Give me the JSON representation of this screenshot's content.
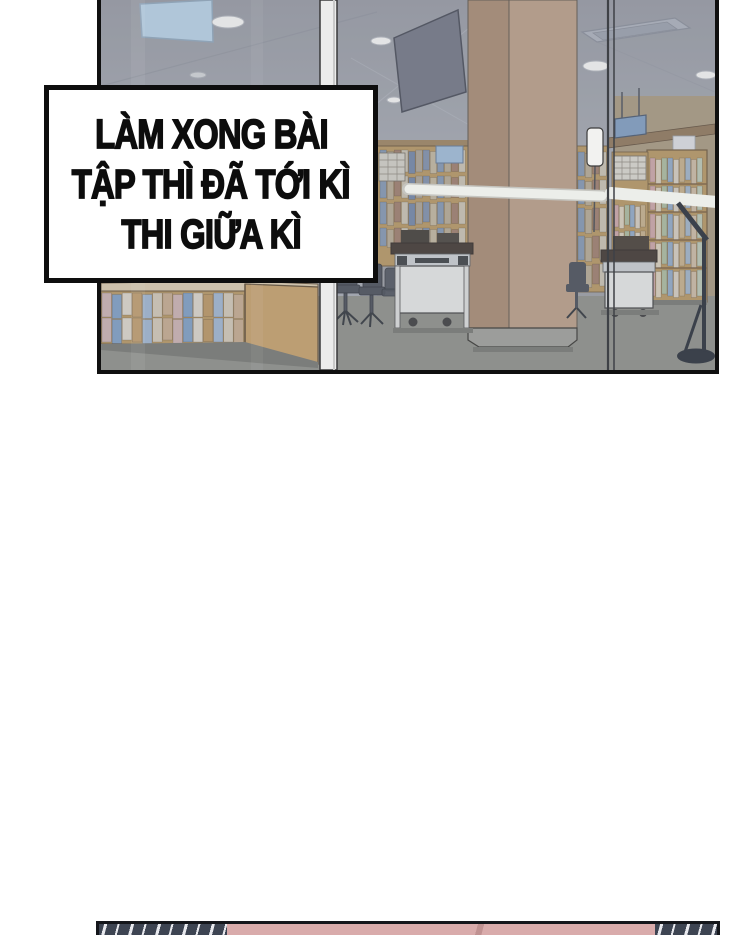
{
  "page": {
    "background": "#ffffff",
    "kind": "webtoon page segment"
  },
  "caption": {
    "lines": [
      "LÀM XONG BÀI",
      "TẬP THÌ ĐÃ TỚI KÌ",
      "THI GIỮA KÌ"
    ],
    "text_color": "#0d0d0d",
    "background": "#ffffff",
    "border_color": "#0e0e0e"
  },
  "panel": {
    "description": "library interior seen through a glass wall",
    "border_color": "#101010",
    "colors": {
      "wall_top": "#94979f",
      "wall_bottom": "#a3a7ae",
      "glass_haze": "#9ba3b0",
      "skylight_blue": "#b5cfe2",
      "ceiling_light": "#f3f3f1",
      "vent_gray": "#a9aeb8",
      "vent_inner": "#989ea9",
      "screen_dark": "#6f7380",
      "column_front": "#b79c83",
      "column_side": "#a5886e",
      "column_base": "#9d9d96",
      "shelf_wood": "#b4945f",
      "shelf_wood_dark": "#6b5639",
      "back_wall_tan": "#a5967c",
      "beam_brown": "#8d7557",
      "poster_white": "#d9dbde",
      "hanging_sign_blue": "#7d9abc",
      "small_sign_blue": "#9db9d4",
      "stand_sign_white": "#f2f2f0",
      "card_cabinet_gray": "#d6d3ca",
      "rail_white": "#eceeea",
      "mullion_white": "#ececec",
      "glass_line": "#3e4146",
      "wall_behind_desks": "#999ba0",
      "desk_top_dark": "#3d342c",
      "desk_body_white": "#e3e5e2",
      "desk_detail_gray": "#c7cbce",
      "chair_dark": "#474c55",
      "floor_gray": "#8c8d86",
      "floor_shadow": "#75766f",
      "lamp_dark": "#3b414b",
      "book_palette_right": [
        "#c9a3a3",
        "#d6ccb8",
        "#a9b79a",
        "#8ea6c2",
        "#d2cabb",
        "#c2ad87",
        "#9db0c4",
        "#c8b7a0",
        "#b7c4b0"
      ],
      "book_palette_mid": [
        "#8194ae",
        "#b3a78f",
        "#9b7a68",
        "#c6bfae",
        "#6f83a3",
        "#a89f90",
        "#7d8da6",
        "#bdb29a"
      ],
      "book_palette_low": [
        "#c9afae",
        "#7c9cc0",
        "#d8d2c6",
        "#b8935f",
        "#9db3cc",
        "#cfc5b2",
        "#c2a88a"
      ]
    }
  },
  "next_panel_strip": {
    "hatch_base": "#3d4452",
    "hatch_stripe": "#e8e9ee",
    "pink": "#d9abab",
    "pink_line": "#c09191"
  }
}
